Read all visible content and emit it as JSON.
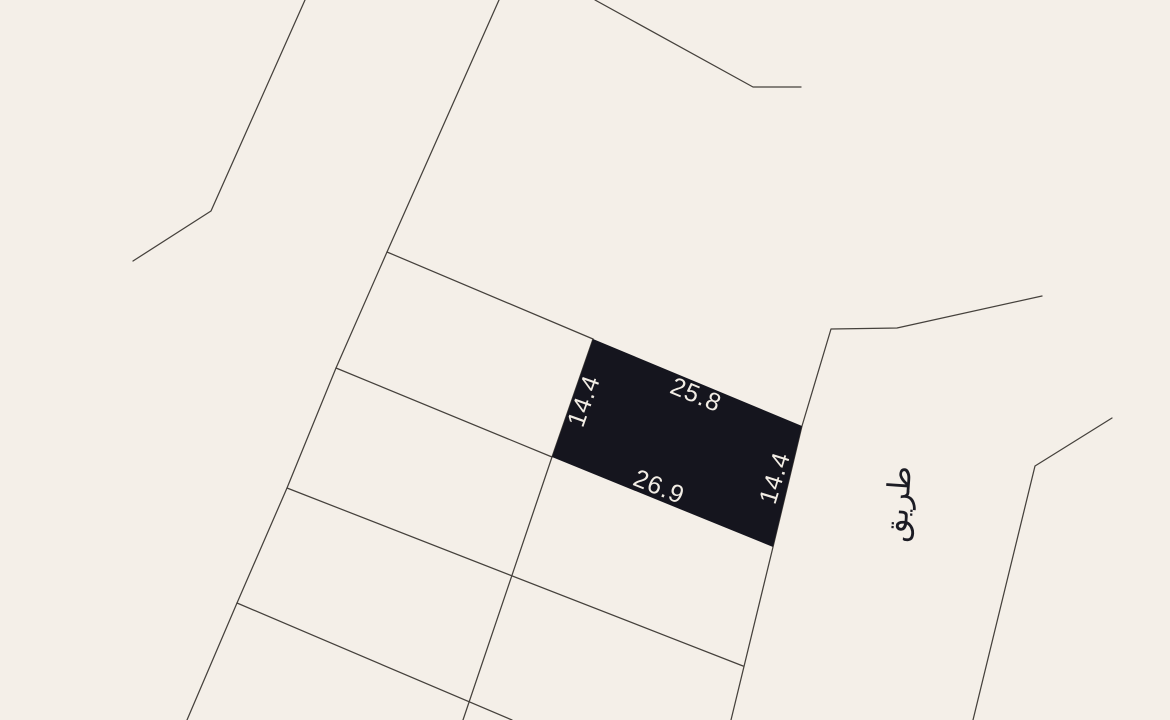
{
  "map": {
    "background_color": "#f4efe8",
    "boundary_color": "#45413c",
    "highlighted_parcel": {
      "fill_color": "#15151e",
      "label_color": "#f2ede5",
      "dimensions": {
        "top": "25.8",
        "left": "14.4",
        "bottom": "26.9",
        "right": "14.4"
      }
    },
    "road": {
      "label": "طريق",
      "label_color": "#1c1c24"
    }
  }
}
